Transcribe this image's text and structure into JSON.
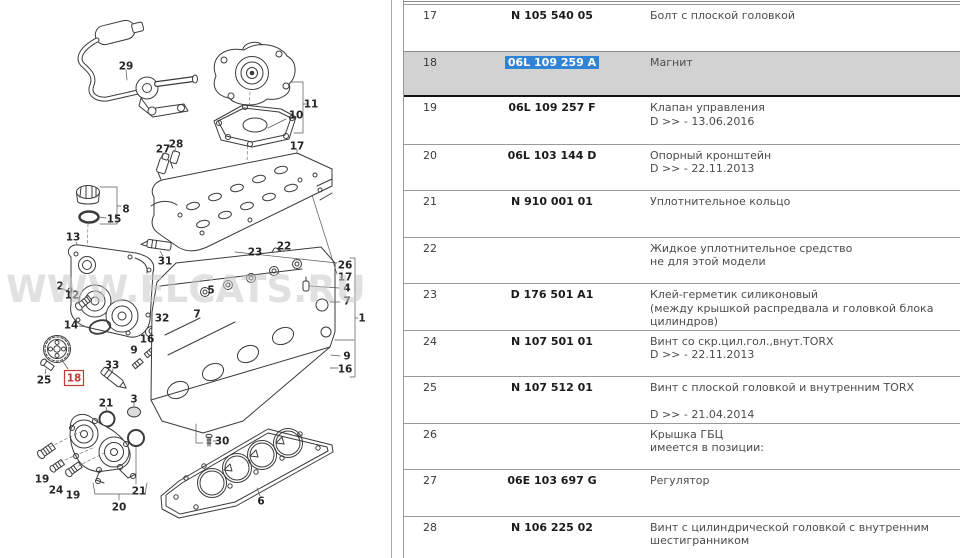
{
  "colors": {
    "row_border": "#9a9a9a",
    "highlight_row_bg": "#d2d2d2",
    "highlight_row_border": "#141414",
    "selection_bg": "#3183d6",
    "selection_text": "#ffffff",
    "part_text": "#1b1b1b",
    "num_text": "#3a3a3a",
    "desc_text": "#4c4c4c",
    "callout_red": "#c23b36",
    "watermark_gray": "#c9c9c9"
  },
  "diagram": {
    "watermark": "WWW.ELCATS.RU",
    "highlighted_callout": "18",
    "callouts": [
      {
        "label": "29",
        "x": 126,
        "y": 66
      },
      {
        "label": "11",
        "x": 311,
        "y": 104
      },
      {
        "label": "10",
        "x": 296,
        "y": 115
      },
      {
        "label": "27",
        "x": 163,
        "y": 149
      },
      {
        "label": "28",
        "x": 176,
        "y": 144
      },
      {
        "label": "17",
        "x": 297,
        "y": 146
      },
      {
        "label": "8",
        "x": 126,
        "y": 209
      },
      {
        "label": "15",
        "x": 114,
        "y": 219
      },
      {
        "label": "13",
        "x": 73,
        "y": 237
      },
      {
        "label": "31",
        "x": 165,
        "y": 261
      },
      {
        "label": "23",
        "x": 255,
        "y": 252
      },
      {
        "label": "22",
        "x": 284,
        "y": 246
      },
      {
        "label": "26",
        "x": 345,
        "y": 265
      },
      {
        "label": "17",
        "x": 345,
        "y": 277
      },
      {
        "label": "4",
        "x": 347,
        "y": 288
      },
      {
        "label": "7",
        "x": 347,
        "y": 301
      },
      {
        "label": "1",
        "x": 362,
        "y": 318
      },
      {
        "label": "9",
        "x": 347,
        "y": 356
      },
      {
        "label": "16",
        "x": 345,
        "y": 369
      },
      {
        "label": "2",
        "x": 60,
        "y": 286
      },
      {
        "label": "12",
        "x": 72,
        "y": 295
      },
      {
        "label": "14",
        "x": 71,
        "y": 325
      },
      {
        "label": "25",
        "x": 44,
        "y": 380
      },
      {
        "label": "18",
        "x": 74,
        "y": 378,
        "red": true
      },
      {
        "label": "33",
        "x": 112,
        "y": 365
      },
      {
        "label": "32",
        "x": 162,
        "y": 318
      },
      {
        "label": "16",
        "x": 147,
        "y": 339
      },
      {
        "label": "9",
        "x": 134,
        "y": 350
      },
      {
        "label": "7",
        "x": 197,
        "y": 314
      },
      {
        "label": "5",
        "x": 211,
        "y": 290
      },
      {
        "label": "3",
        "x": 134,
        "y": 399
      },
      {
        "label": "21",
        "x": 106,
        "y": 403
      },
      {
        "label": "21",
        "x": 139,
        "y": 491
      },
      {
        "label": "19",
        "x": 42,
        "y": 479
      },
      {
        "label": "24",
        "x": 56,
        "y": 490
      },
      {
        "label": "19",
        "x": 73,
        "y": 495
      },
      {
        "label": "20",
        "x": 119,
        "y": 507
      },
      {
        "label": "30",
        "x": 222,
        "y": 441
      },
      {
        "label": "6",
        "x": 261,
        "y": 501
      }
    ]
  },
  "table": {
    "rows": [
      {
        "num": "17",
        "part": "N 105 540 05",
        "desc": [
          "Болт с плоской головкой"
        ]
      },
      {
        "num": "18",
        "part": "06L 109 259 A",
        "desc": [
          "Магнит"
        ],
        "highlighted": true,
        "part_selected": true
      },
      {
        "num": "19",
        "part": "06L 109 257 F",
        "desc": [
          "Клапан управления",
          "D >> - 13.06.2016"
        ]
      },
      {
        "num": "20",
        "part": "06L 103 144 D",
        "desc": [
          "Опорный кронштейн",
          "D >> - 22.11.2013"
        ]
      },
      {
        "num": "21",
        "part": "N 910 001 01",
        "desc": [
          "Уплотнительное кольцо"
        ]
      },
      {
        "num": "22",
        "part": "",
        "desc": [
          "Жидкое уплотнительное средство",
          "не для этой модели"
        ]
      },
      {
        "num": "23",
        "part": "D 176 501 A1",
        "desc": [
          "Клей-герметик силиконовый",
          "(между крышкой распредвала и головкой блока цилиндров)"
        ]
      },
      {
        "num": "24",
        "part": "N 107 501 01",
        "desc": [
          "Винт со скр.цил.гол.,внут.TORX",
          "D >> - 22.11.2013"
        ]
      },
      {
        "num": "25",
        "part": "N 107 512 01",
        "desc": [
          "Винт с плоской головкой и внутренним TORX",
          "",
          "D >> - 21.04.2014"
        ]
      },
      {
        "num": "26",
        "part": "",
        "desc": [
          "Крышка ГБЦ",
          "имеется в позиции:"
        ]
      },
      {
        "num": "27",
        "part": "06E 103 697 G",
        "desc": [
          "Регулятор"
        ]
      },
      {
        "num": "28",
        "part": "N 106 225 02",
        "desc": [
          "Винт с цилиндрической головкой с внутренним шестигранником"
        ]
      }
    ]
  }
}
